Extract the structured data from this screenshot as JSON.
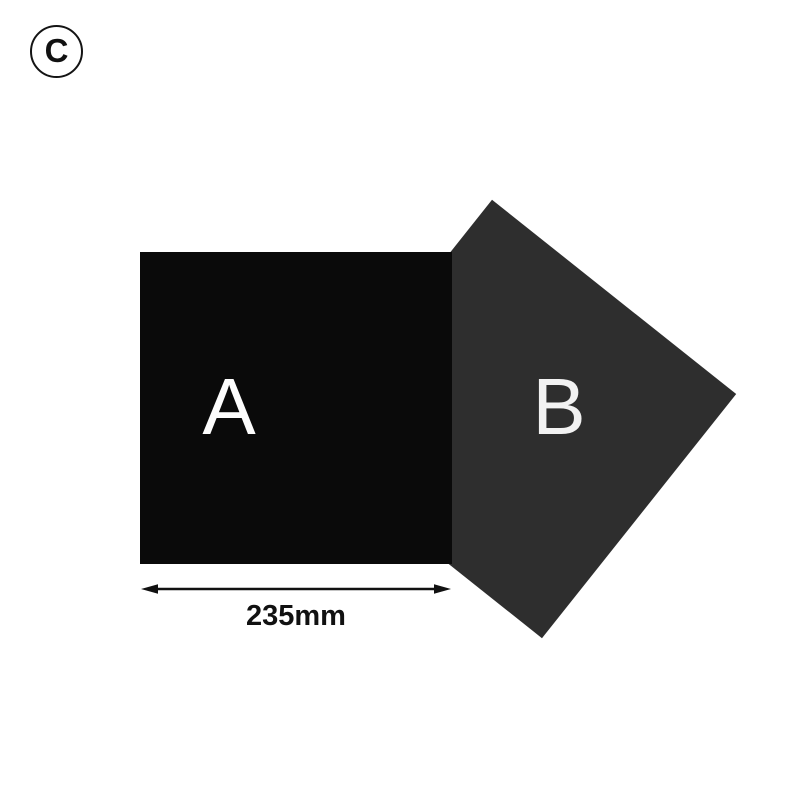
{
  "badge": {
    "label": "C",
    "border_color": "#141414",
    "text_color": "#111111"
  },
  "shapes": {
    "square_a": {
      "label": "A",
      "fill": "#0a0a0a",
      "label_color": "#fdfdfd"
    },
    "square_b": {
      "label": "B",
      "fill": "#2e2e2e",
      "label_color": "#f2f2f2",
      "rotation_deg": 38.5
    }
  },
  "dimension": {
    "label": "235mm",
    "color": "#111111"
  }
}
